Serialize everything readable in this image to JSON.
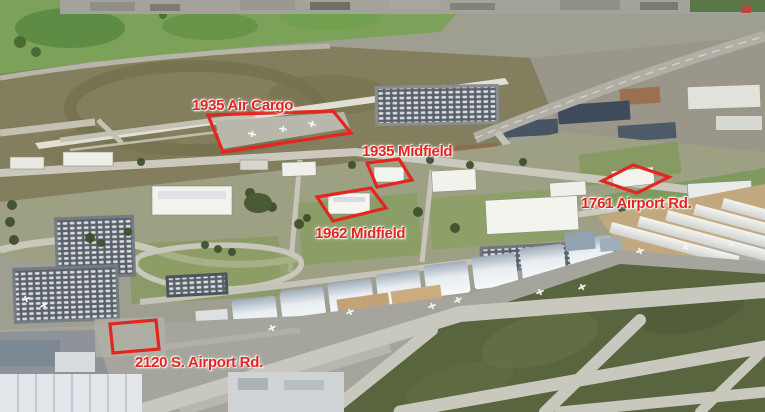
{
  "annotations": {
    "stroke_color": "#e32620",
    "text_color": "#e32620",
    "items": [
      {
        "id": "air-cargo",
        "label": "1935 Air Cargo"
      },
      {
        "id": "midfield-1935",
        "label": "1935 Midfield"
      },
      {
        "id": "midfield-1962",
        "label": "1962 Midfield"
      },
      {
        "id": "airport-rd-1761",
        "label": "1761 Airport Rd."
      },
      {
        "id": "s-airport-rd-2120",
        "label": "2120 S. Airport Rd."
      }
    ]
  }
}
